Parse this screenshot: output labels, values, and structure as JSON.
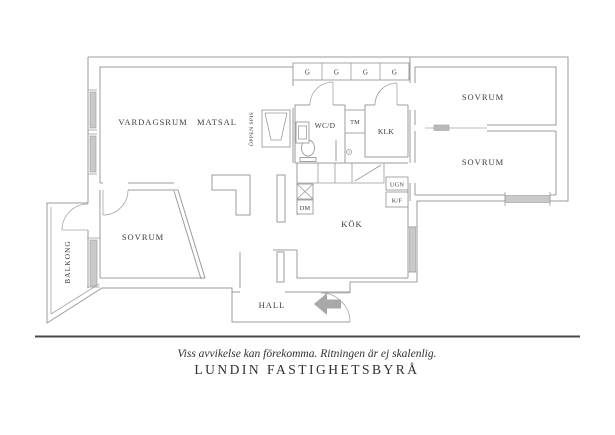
{
  "colors": {
    "background": "#ffffff",
    "wall": "#9b9b9b",
    "text": "#3b3b3b",
    "window_glass": "#c9c9c9",
    "entry_arrow": "#a8a8a8",
    "separator_line": "#4a4a4a"
  },
  "rooms": {
    "vardagsrum": "VARDAGSRUM",
    "matsal": "MATSAL",
    "sovrum1": "SOVRUM",
    "sovrum2": "SOVRUM",
    "sovrum3": "SOVRUM",
    "kok": "KÖK",
    "hall": "HALL",
    "balkong": "BALKONG",
    "wcd": "WC/D",
    "klk": "KLK"
  },
  "fixtures": {
    "garderob": "G",
    "tvattmaskin": "TM",
    "diskmaskin": "DM",
    "ugn": "UGN",
    "kyl_frys": "K/F",
    "oppen_spis": "ÖPPEN SPIS"
  },
  "footer": {
    "disclaimer": "Viss avvikelse kan förekomma. Ritningen är ej skalenlig.",
    "brand": "LUNDIN FASTIGHETSBYRÅ"
  }
}
